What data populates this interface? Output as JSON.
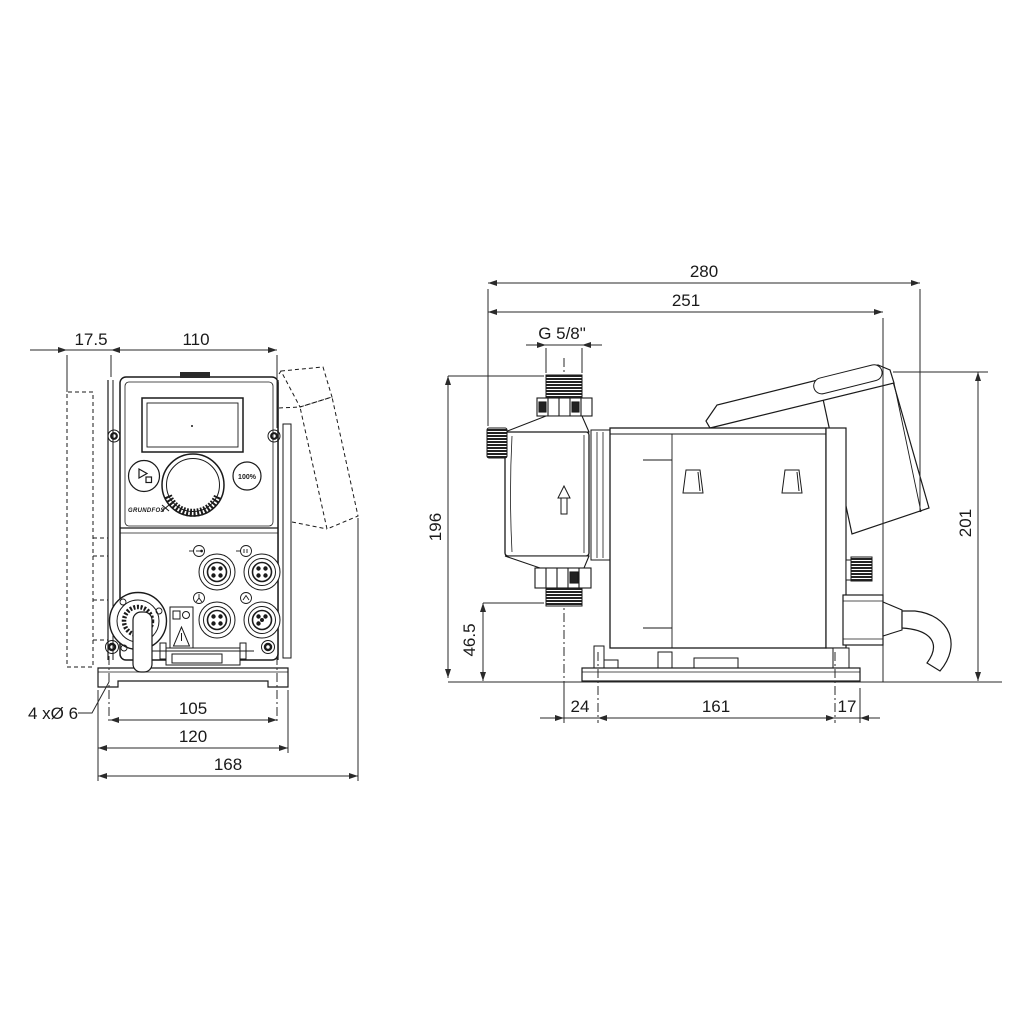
{
  "drawing": {
    "type": "dimensional technical drawing, dosing pump, front and side views",
    "units": "mm"
  },
  "front_view": {
    "dim_offset": "17.5",
    "dim_panel_width": "110",
    "dim_hole_spacing": "105",
    "dim_plate_width": "120",
    "dim_total_width": "168",
    "hole_callout": "4 xØ 6",
    "percent_button": "100%",
    "logo": "GRUNDFOS"
  },
  "side_view": {
    "dim_total_depth": "280",
    "dim_body_depth": "251",
    "thread_label": "G 5/8\"",
    "dim_height": "196",
    "dim_outlet_height": "46.5",
    "dim_cube_height": "201",
    "dim_base_front": "24",
    "dim_base_holes": "161",
    "dim_base_rear": "17"
  },
  "colors": {
    "line": "#1a1a1a",
    "dimension": "#2a2a2a",
    "background": "#ffffff"
  }
}
